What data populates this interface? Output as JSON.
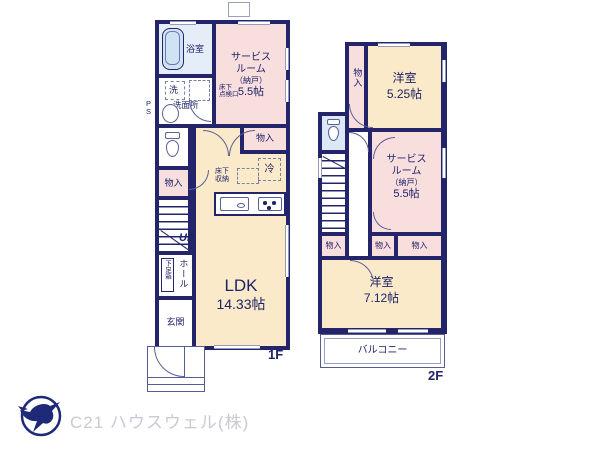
{
  "floor1": {
    "floor_label": "1F",
    "bath": "浴室",
    "wash_machine": "洗",
    "washroom": "洗面所",
    "underfloor_hatch": [
      "床下",
      "点検口"
    ],
    "ps": [
      "P",
      "S"
    ],
    "service_room": [
      "サービス",
      "ルーム",
      "（納戸）",
      "5.5帖"
    ],
    "storage_left": "物入",
    "storage_right": "物入",
    "fridge": "冷",
    "underfloor_storage": [
      "床下",
      "収納"
    ],
    "up": "UP",
    "shoe_box": "下足箱",
    "hall": "ホール",
    "entrance": "玄関",
    "ldk_name": "LDK",
    "ldk_size": "14.33帖"
  },
  "floor2": {
    "floor_label": "2F",
    "storage_top": "物入",
    "room_a_name": "洋室",
    "room_a_size": "5.25帖",
    "dn": "DN",
    "service_room": [
      "サービス",
      "ルーム",
      "（納戸）",
      "5.5帖"
    ],
    "storage_left": "物入",
    "storage_mid": "物入",
    "storage_right": "物入",
    "room_b_name": "洋室",
    "room_b_size": "7.12帖",
    "balcony": "バルコニー"
  },
  "footer": {
    "company": "C21 ハウスウェル(株)"
  },
  "colors": {
    "wall": "#23246a",
    "room_pink": "#f9dede",
    "room_cream": "#faeaca",
    "water_blue": "#e4edf8",
    "toilet_blue": "#dce8f5",
    "logo_navy": "#1e2a78",
    "footer_gray": "#c9cad4"
  }
}
